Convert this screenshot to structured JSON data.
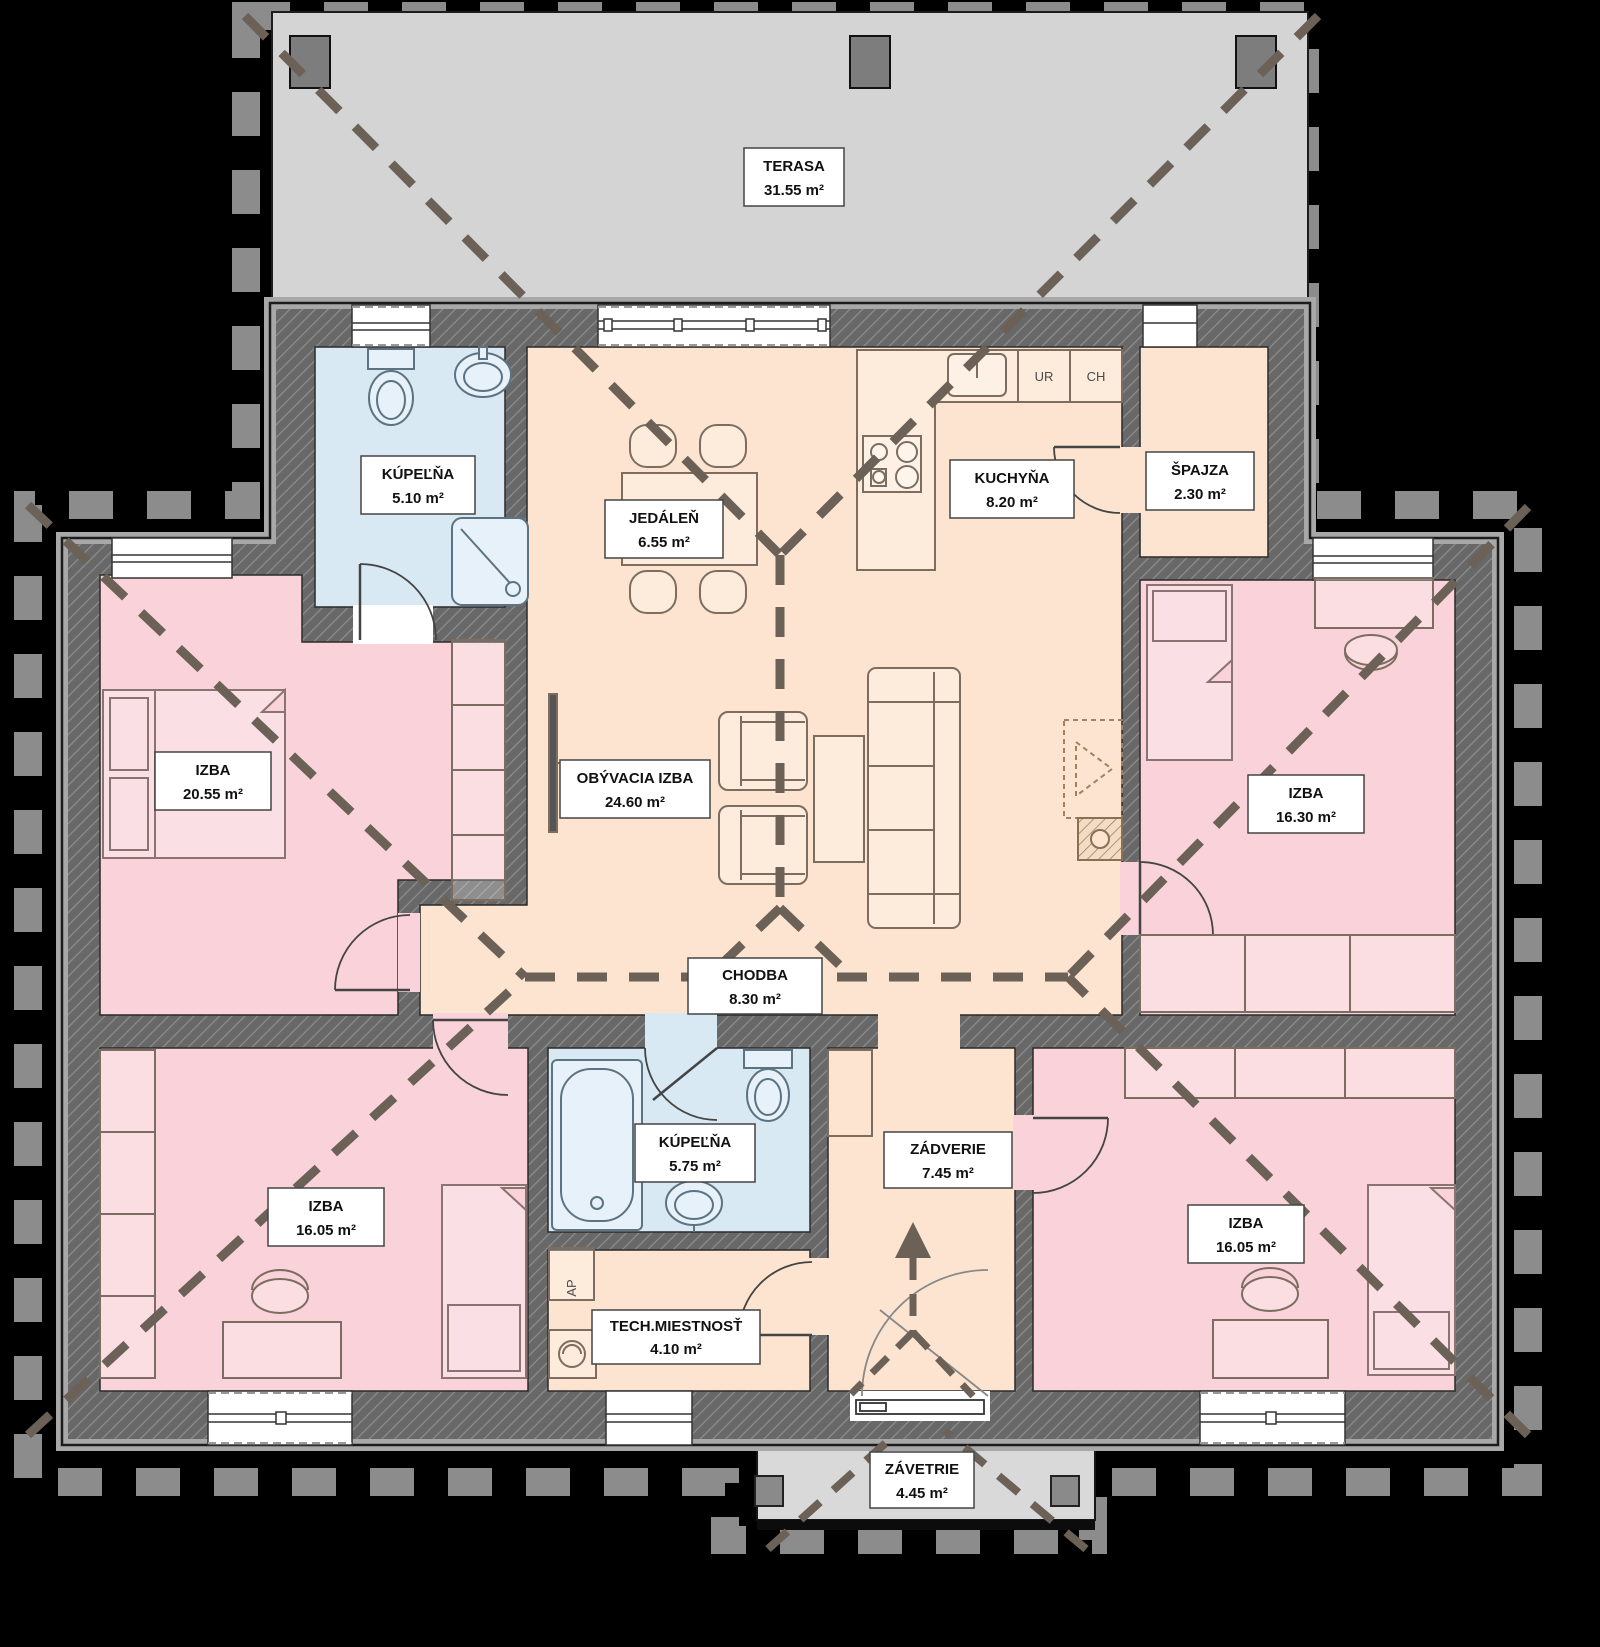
{
  "plan": {
    "title": "Floor plan (bungalow)",
    "rooms": {
      "terasa": {
        "name": "TERASA",
        "area": "31.55 m²"
      },
      "kupelna_top": {
        "name": "KÚPEĽŇA",
        "area": "5.10 m²"
      },
      "jedalen": {
        "name": "JEDÁLEŇ",
        "area": "6.55 m²"
      },
      "kuchyna": {
        "name": "KUCHYŇA",
        "area": "8.20 m²"
      },
      "spajza": {
        "name": "ŠPAJZA",
        "area": "2.30 m²"
      },
      "izba_left": {
        "name": "IZBA",
        "area": "20.55 m²"
      },
      "obyvacia": {
        "name": "OBÝVACIA IZBA",
        "area": "24.60 m²"
      },
      "izba_right": {
        "name": "IZBA",
        "area": "16.30 m²"
      },
      "chodba": {
        "name": "CHODBA",
        "area": "8.30 m²"
      },
      "izba_bottom_left": {
        "name": "IZBA",
        "area": "16.05 m²"
      },
      "kupelna_bottom": {
        "name": "KÚPEĽŇA",
        "area": "5.75 m²"
      },
      "zadverie": {
        "name": "ZÁDVERIE",
        "area": "7.45 m²"
      },
      "izba_bottom_right": {
        "name": "IZBA",
        "area": "16.05 m²"
      },
      "tech_miestnost": {
        "name": "TECH.MIESTNOSŤ",
        "area": "4.10 m²"
      },
      "zavetrie": {
        "name": "ZÁVETRIE",
        "area": "4.45 m²"
      }
    },
    "appliance_labels": {
      "ur": "UR",
      "ch": "CH",
      "ap": "AP"
    },
    "colors": {
      "background": "#000000",
      "bedroom_pink": "#f9d3d9",
      "living_peach": "#fde4d0",
      "bathroom_blue": "#d8e9f4",
      "terrace_gray": "#d4d4d4",
      "porch_gray": "#d9d9d9",
      "wall_gray": "#686868",
      "roof_dash_gray": "#8c8c8c",
      "ridge_dash_brown": "#6b6156"
    }
  }
}
